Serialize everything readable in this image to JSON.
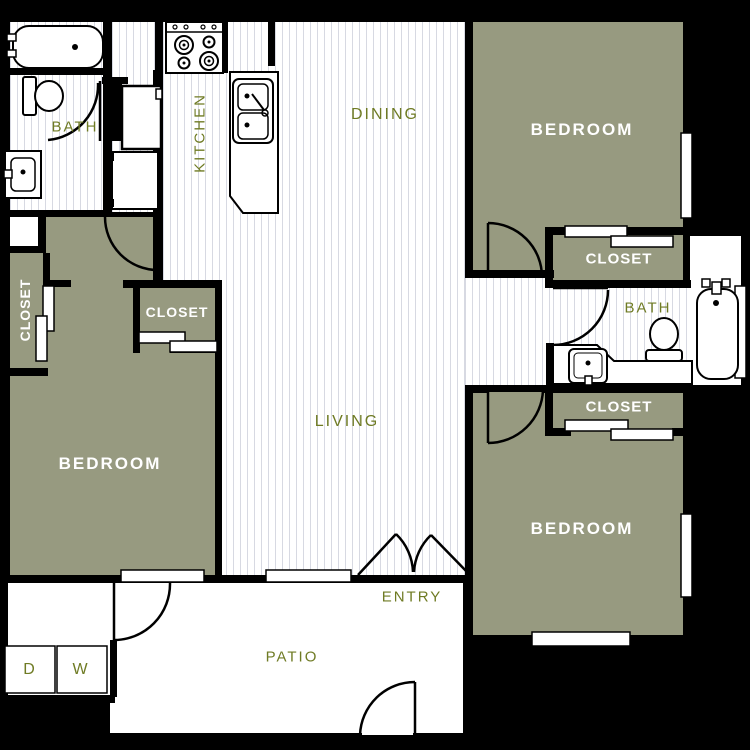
{
  "palette": {
    "background": "#000000",
    "wall": "#000000",
    "room_fill": "#979a80",
    "floor_stripe": "#d7d9e2",
    "label_green": "#6f7b24",
    "label_white": "#ffffff"
  },
  "rooms": {
    "bath_left": "BATH",
    "kitchen": "KITCHEN",
    "dining": "DINING",
    "living": "LIVING",
    "entry": "ENTRY",
    "patio": "PATIO",
    "bath_right": "BATH",
    "bedroom_top_right": "BEDROOM",
    "closet_top_right": "CLOSET",
    "closet_mid_right": "CLOSET",
    "bedroom_bottom_right": "BEDROOM",
    "closet_hall": "CLOSET",
    "closet_left": "CLOSET",
    "bedroom_left": "BEDROOM"
  },
  "appliances": {
    "dryer": "D",
    "washer": "W"
  }
}
